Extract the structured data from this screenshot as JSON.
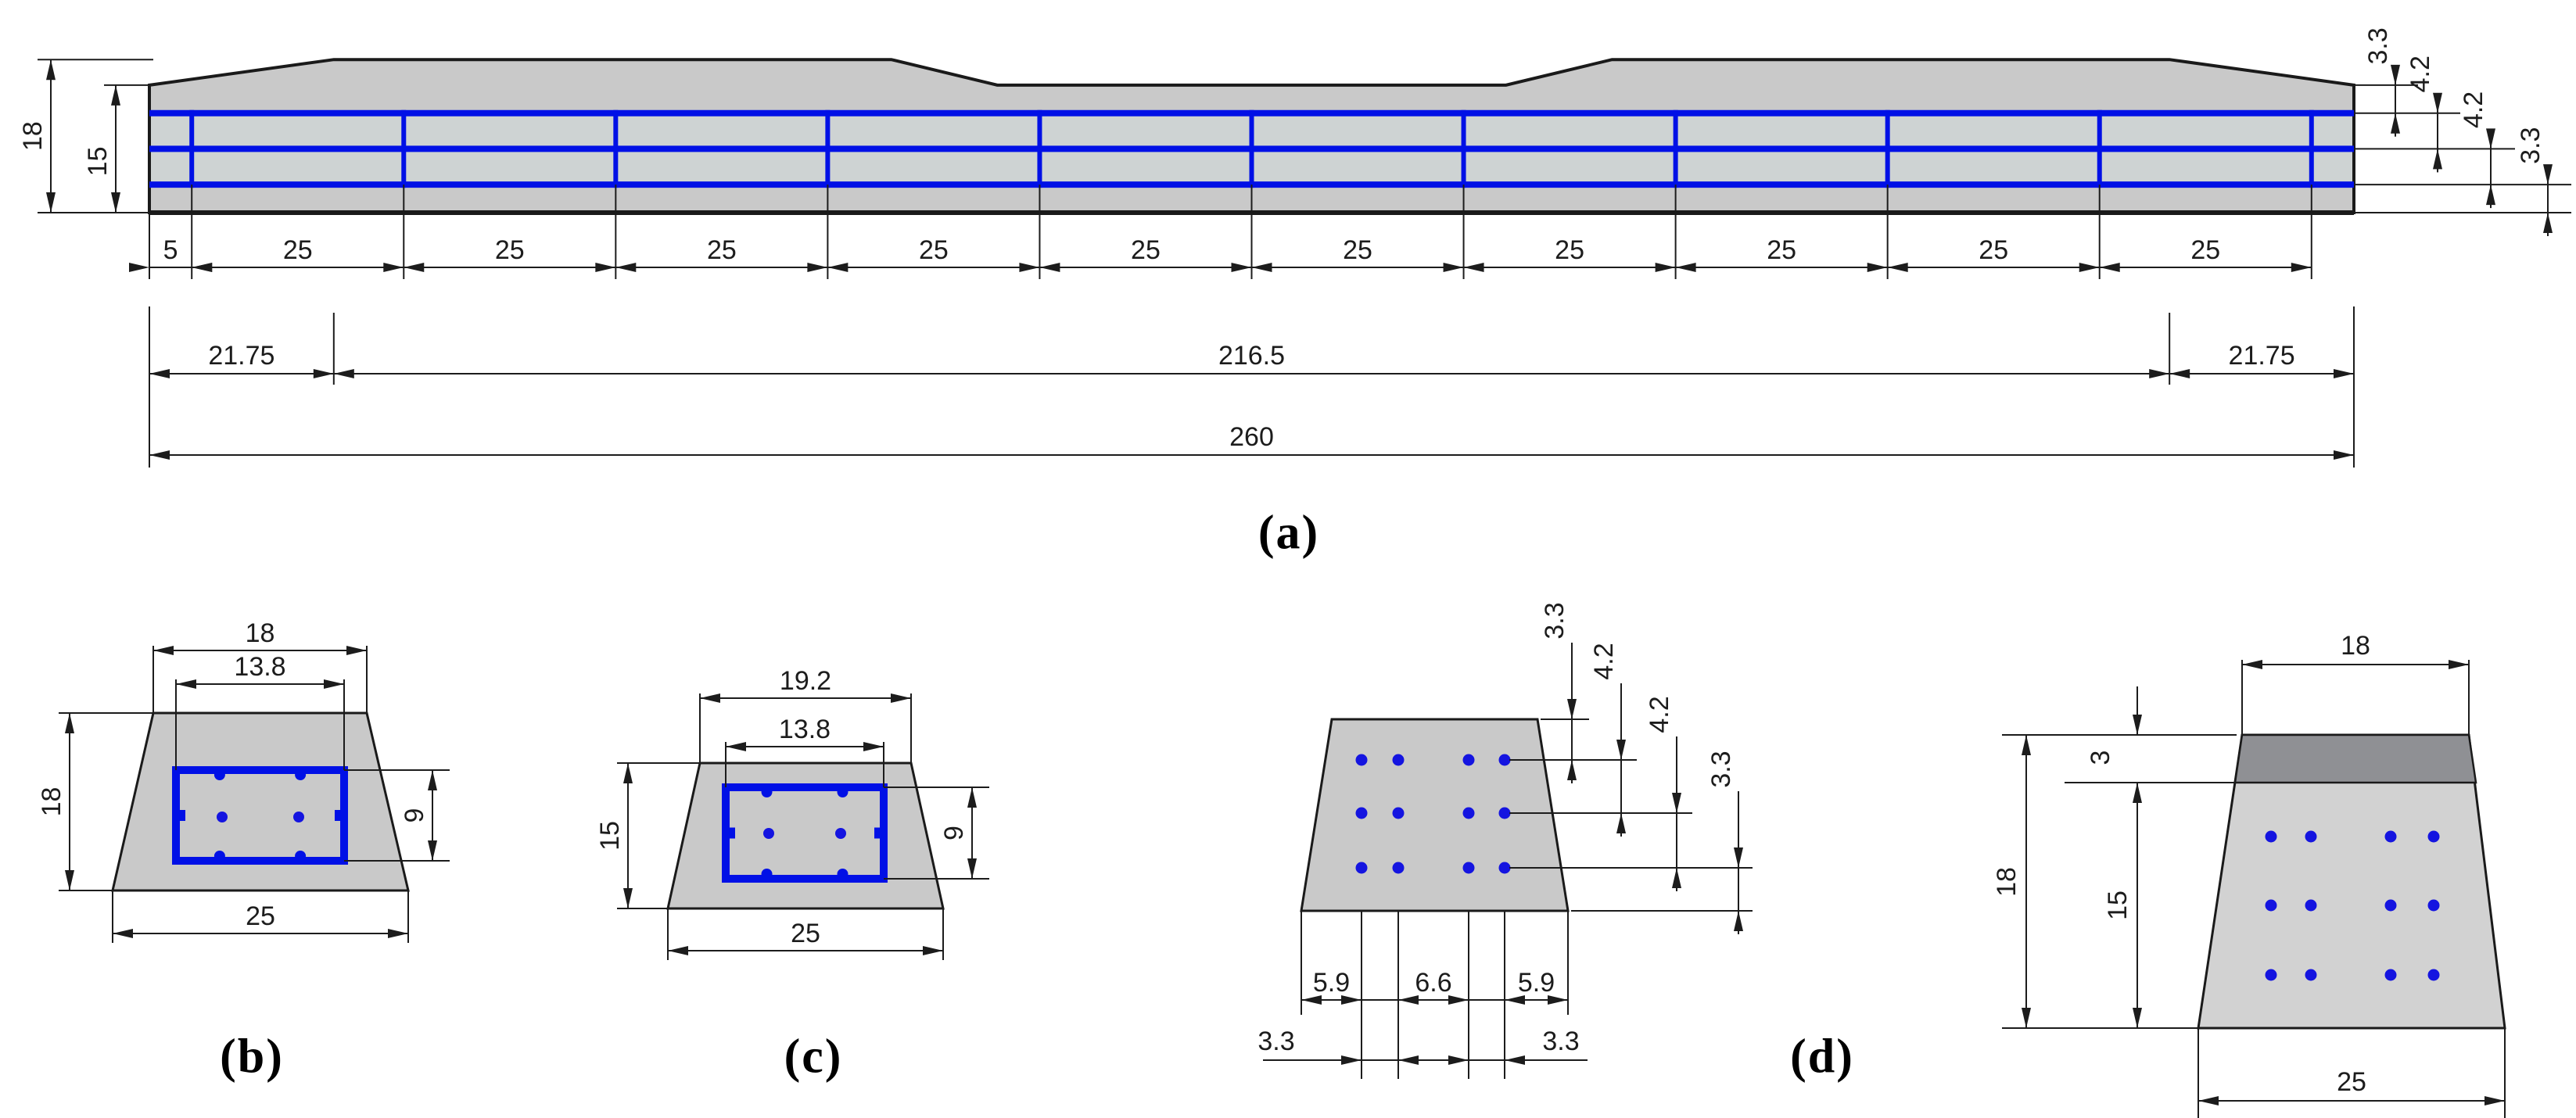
{
  "figure_labels": {
    "a": "(a)",
    "b": "(b)",
    "c": "(c)",
    "d": "(d)"
  },
  "colors": {
    "concrete": "#c9c9c9",
    "concrete_light": "#d2d2d2",
    "between_rebar_strip": "#ced3d3",
    "rebar_blue": "#0010e6",
    "strand_dot_blue": "#1414e0",
    "dark_top_band": "#8f9094",
    "outline": "#1a1a1a",
    "dim_line": "#1c1c1c",
    "dim_text": "#1c1c1c",
    "background": "#ffffff"
  },
  "panel_a": {
    "label": "(a)",
    "beam": {
      "length": 260,
      "max_height": 18,
      "end_height": 15,
      "top_profile_x": [
        0,
        21.75,
        87.5,
        100,
        160,
        172.5,
        238.25,
        260
      ],
      "top_profile_h": [
        15,
        18,
        18,
        15,
        15,
        18,
        18,
        15
      ],
      "rebar_layer_heights_from_bottom": [
        11.7,
        7.5,
        3.3
      ],
      "stirrup_positions": [
        5,
        30,
        55,
        80,
        105,
        130,
        155,
        180,
        205,
        230,
        255
      ]
    },
    "dim_left_outer": "18",
    "dim_left_inner": "15",
    "dims_right": [
      "3.3",
      "4.2",
      "4.2",
      "3.3"
    ],
    "dims_row1": [
      "5",
      "25",
      "25",
      "25",
      "25",
      "25",
      "25",
      "25",
      "25",
      "25",
      "25"
    ],
    "dims_row2": [
      "21.75",
      "216.5",
      "21.75"
    ],
    "dims_row3": [
      "260"
    ]
  },
  "panel_b": {
    "label": "(b)",
    "dim_top": "18",
    "dim_inner_top": "13.8",
    "dim_left": "18",
    "dim_right": "9",
    "dim_bottom": "25"
  },
  "panel_c": {
    "label": "(c)",
    "dim_top": "19.2",
    "dim_inner_top": "13.8",
    "dim_left": "15",
    "dim_right": "9",
    "dim_bottom": "25"
  },
  "panel_d": {
    "label": "(d)",
    "left_section": {
      "dims_right": [
        "3.3",
        "4.2",
        "4.2",
        "3.3"
      ],
      "dims_bottom_inner": [
        "5.9",
        "6.6",
        "5.9"
      ],
      "dims_bottom_outer": [
        "3.3",
        "3.3"
      ],
      "strand_rows": 3,
      "strand_cols": 4
    },
    "right_section": {
      "dim_top": "18",
      "dim_band": "3",
      "dim_left_outer": "18",
      "dim_left_inner": "15",
      "dim_bottom": "25",
      "strand_rows": 3,
      "strand_cols": 4
    }
  }
}
